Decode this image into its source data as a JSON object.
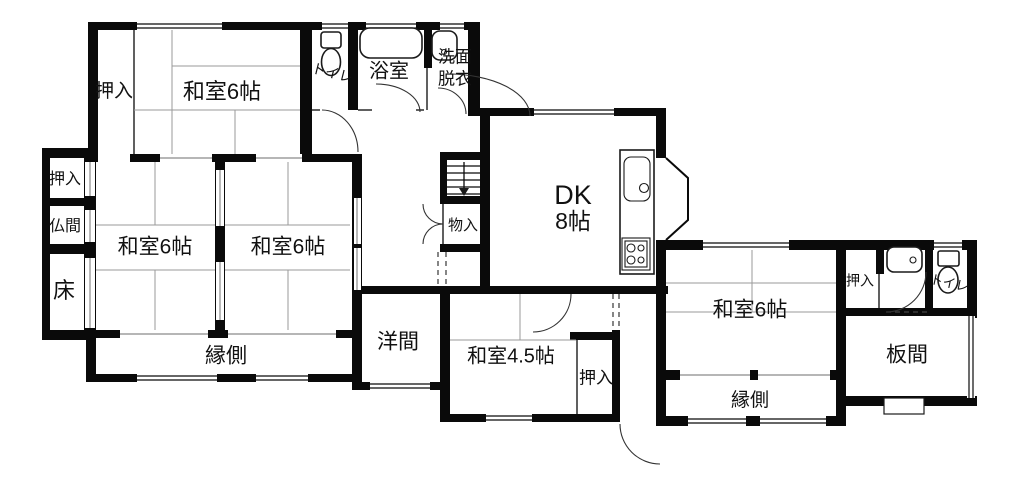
{
  "plan": {
    "kind": "japanese-house-floor-plan",
    "colors": {
      "wall": "#0a0a0a",
      "background": "#ffffff",
      "tatami_line": "#9a9a9a"
    },
    "labels": {
      "oshiire_top_left": "押入",
      "washitsu_top": "和室6帖",
      "toilet_top": "トイレ",
      "bathroom": "浴室",
      "senmen": "洗面",
      "datsui": "脱衣",
      "dk": "DK",
      "dk_size": "8帖",
      "oshiire_west": "押入",
      "butsuma": "仏間",
      "toko": "床",
      "washitsu_center_left": "和室6帖",
      "washitsu_center_right": "和室6帖",
      "monoire": "物入",
      "engawa_south": "縁側",
      "youma": "洋間",
      "washitsu_45": "和室4.5帖",
      "oshiire_center": "押入",
      "washitsu_east": "和室6帖",
      "oshiire_east": "押入",
      "toilet_east": "トイレ",
      "itama": "板間",
      "engawa_east": "縁側"
    }
  }
}
